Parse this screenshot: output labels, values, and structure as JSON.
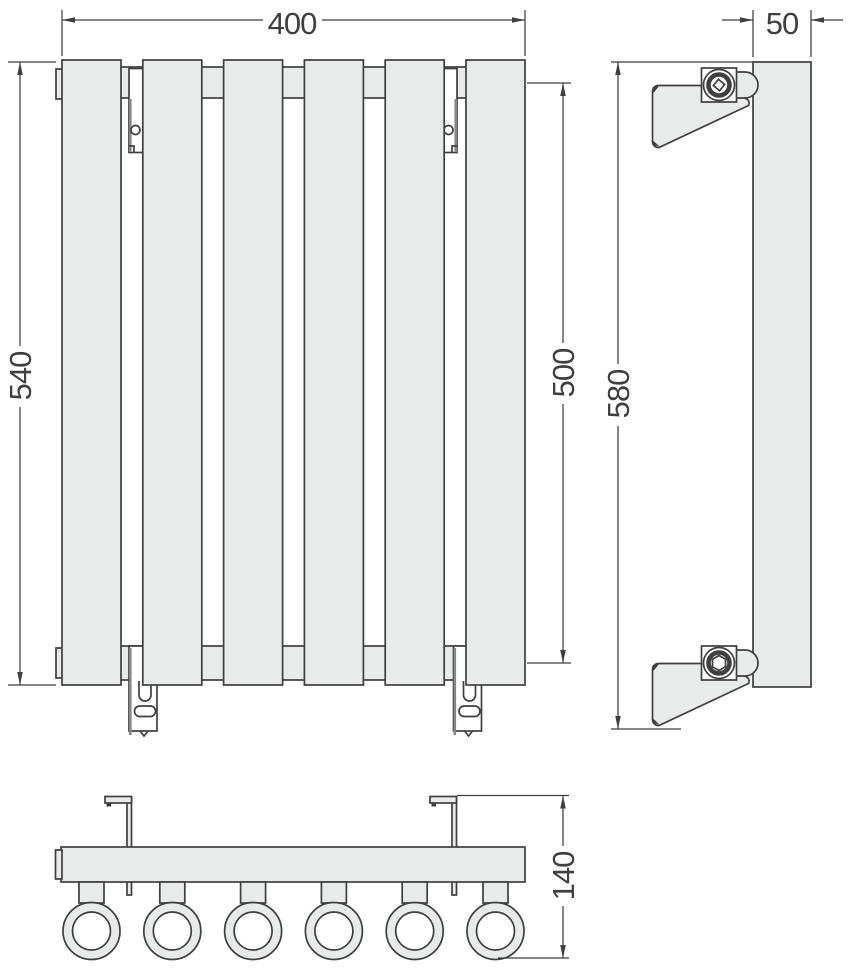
{
  "document": {
    "type": "radiator-technical-drawing",
    "views": {
      "front_view": {
        "section_count": 6,
        "bracket_count": 4
      },
      "side_view": {
        "wall_bracket_count": 2,
        "fitting_top": "square-screw",
        "fitting_bottom": "hex-nut"
      },
      "bottom_view": {
        "tube_count": 6,
        "hook_count": 2
      }
    }
  },
  "dimensions": {
    "front_width": {
      "value": "400"
    },
    "front_height": {
      "value": "540"
    },
    "connection_spacing": {
      "value": "500"
    },
    "side_height": {
      "value": "580"
    },
    "side_width": {
      "value": "50"
    },
    "bottom_depth": {
      "value": "140"
    }
  },
  "colors": {
    "background": "#ffffff",
    "fill_light": "#e9eaea",
    "fill_white": "#ffffff",
    "outline": "#3f3f3f",
    "shadow": "#85888a",
    "dim_color": "#3f3f3f"
  }
}
